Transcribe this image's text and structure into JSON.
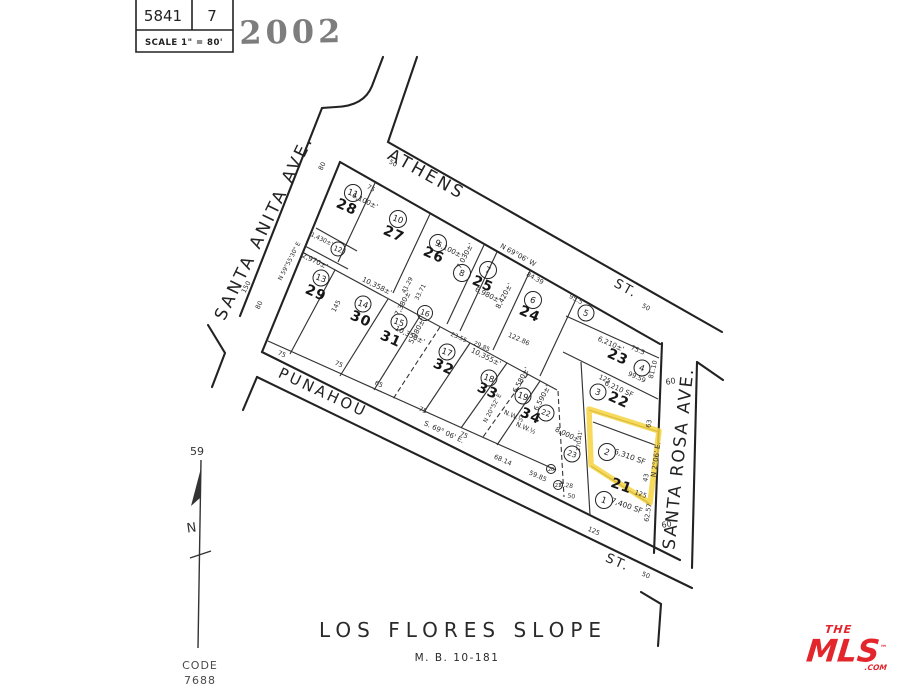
{
  "title_block": {
    "sheet": "5841",
    "page": "7",
    "scale": "SCALE 1\" =  80'"
  },
  "stamp": {
    "year": "2002"
  },
  "compass": {
    "ref": "59",
    "n": "N"
  },
  "code": {
    "line1": "CODE",
    "line2": "7688"
  },
  "subdivision": {
    "name": "LOS FLORES SLOPE",
    "map_book": "M. B. 10-181"
  },
  "streets": {
    "santa_anita": "SANTA ANITA AVE.",
    "athens": "ATHENS",
    "athens_st": "ST.",
    "punahou": "PUNAHOU",
    "bottom_st": "ST.",
    "santa_rosa": "SANTA ROSA AVE."
  },
  "bearings": {
    "athens": "N 69°06' W",
    "punahou": "S. 69° 06' E.",
    "santa_rosa": "N 2°06' E.",
    "west_line": "N 59°55'30\" E",
    "lot34_line": "N 20°52' E"
  },
  "lots": {
    "l21": "21",
    "l22": "22",
    "l23": "23",
    "l24": "24",
    "l25": "25",
    "l26": "26",
    "l27": "27",
    "l28": "28",
    "l29": "29",
    "l30": "30",
    "l31": "31",
    "l32": "32",
    "l33": "33",
    "l34": "34"
  },
  "parcels": {
    "p1": "1",
    "p2": "2",
    "p3": "3",
    "p4": "4",
    "p5": "5",
    "p6": "6",
    "p7": "7",
    "p8": "8",
    "p9": "9",
    "p10": "10",
    "p11": "11",
    "p12": "12",
    "p13": "13",
    "p14": "14",
    "p15": "15",
    "p16": "16",
    "p17": "17",
    "p18": "18",
    "p19": "19",
    "p20": "20",
    "p21": "21",
    "p22": "22",
    "p23": "23"
  },
  "areas": {
    "lot28": "6,100±'",
    "lot26": "6,100±'",
    "sliver25": "7,030±'",
    "lot25": "6,980±'",
    "lot24": "8,420±'",
    "lot23": "6,210±'",
    "lot22": "6,210 SF",
    "parcel2": "6,310 SF",
    "lot21": "7,400 SF",
    "lot29": "2,970±'",
    "parcel12": "1,430±'",
    "lot30": "10,358±'",
    "lot31": "7,380±'",
    "parcel16": "5,980±'",
    "lot32": "10,358±'",
    "lot33": "10,355±'",
    "lot34": "6,580±'",
    "parcel22": "6,590±'",
    "parcel23": "8,000±'"
  },
  "dims": {
    "w_athens": "50",
    "w_athens2": "50",
    "w_sa1": "80",
    "w_sa2": "80",
    "w_sr1": "60",
    "w_sr2": "60",
    "w_bottom": "50",
    "f75a": "75",
    "f75b": "75",
    "f75c": "75",
    "f75d": "75",
    "f75e": "75",
    "f65": "65",
    "f6814": "68.14",
    "f5985": "59.85",
    "f628": "6.28",
    "f50": "50",
    "d8439": "84.39",
    "d955": "95.5",
    "d12286": "122.86",
    "d2355": "23.55",
    "d2985": "29.85",
    "d4129": "41.29",
    "d3371": "33.71",
    "d150": "150",
    "d145": "145",
    "d755": "75.5",
    "d9959": "99.59",
    "d8110": "81.10",
    "d125a": "125",
    "d125b": "125",
    "d125c": "125",
    "d63": "63",
    "d43": "43",
    "d6257": "62.57",
    "d17041": "170.41'",
    "nw1": "N.W.½",
    "nw2": "N.W.½"
  },
  "highlight": {
    "color": "#f6d33f"
  },
  "logo": {
    "the": "THE",
    "mls": "MLS",
    "tm": "™",
    "com": ".COM"
  }
}
